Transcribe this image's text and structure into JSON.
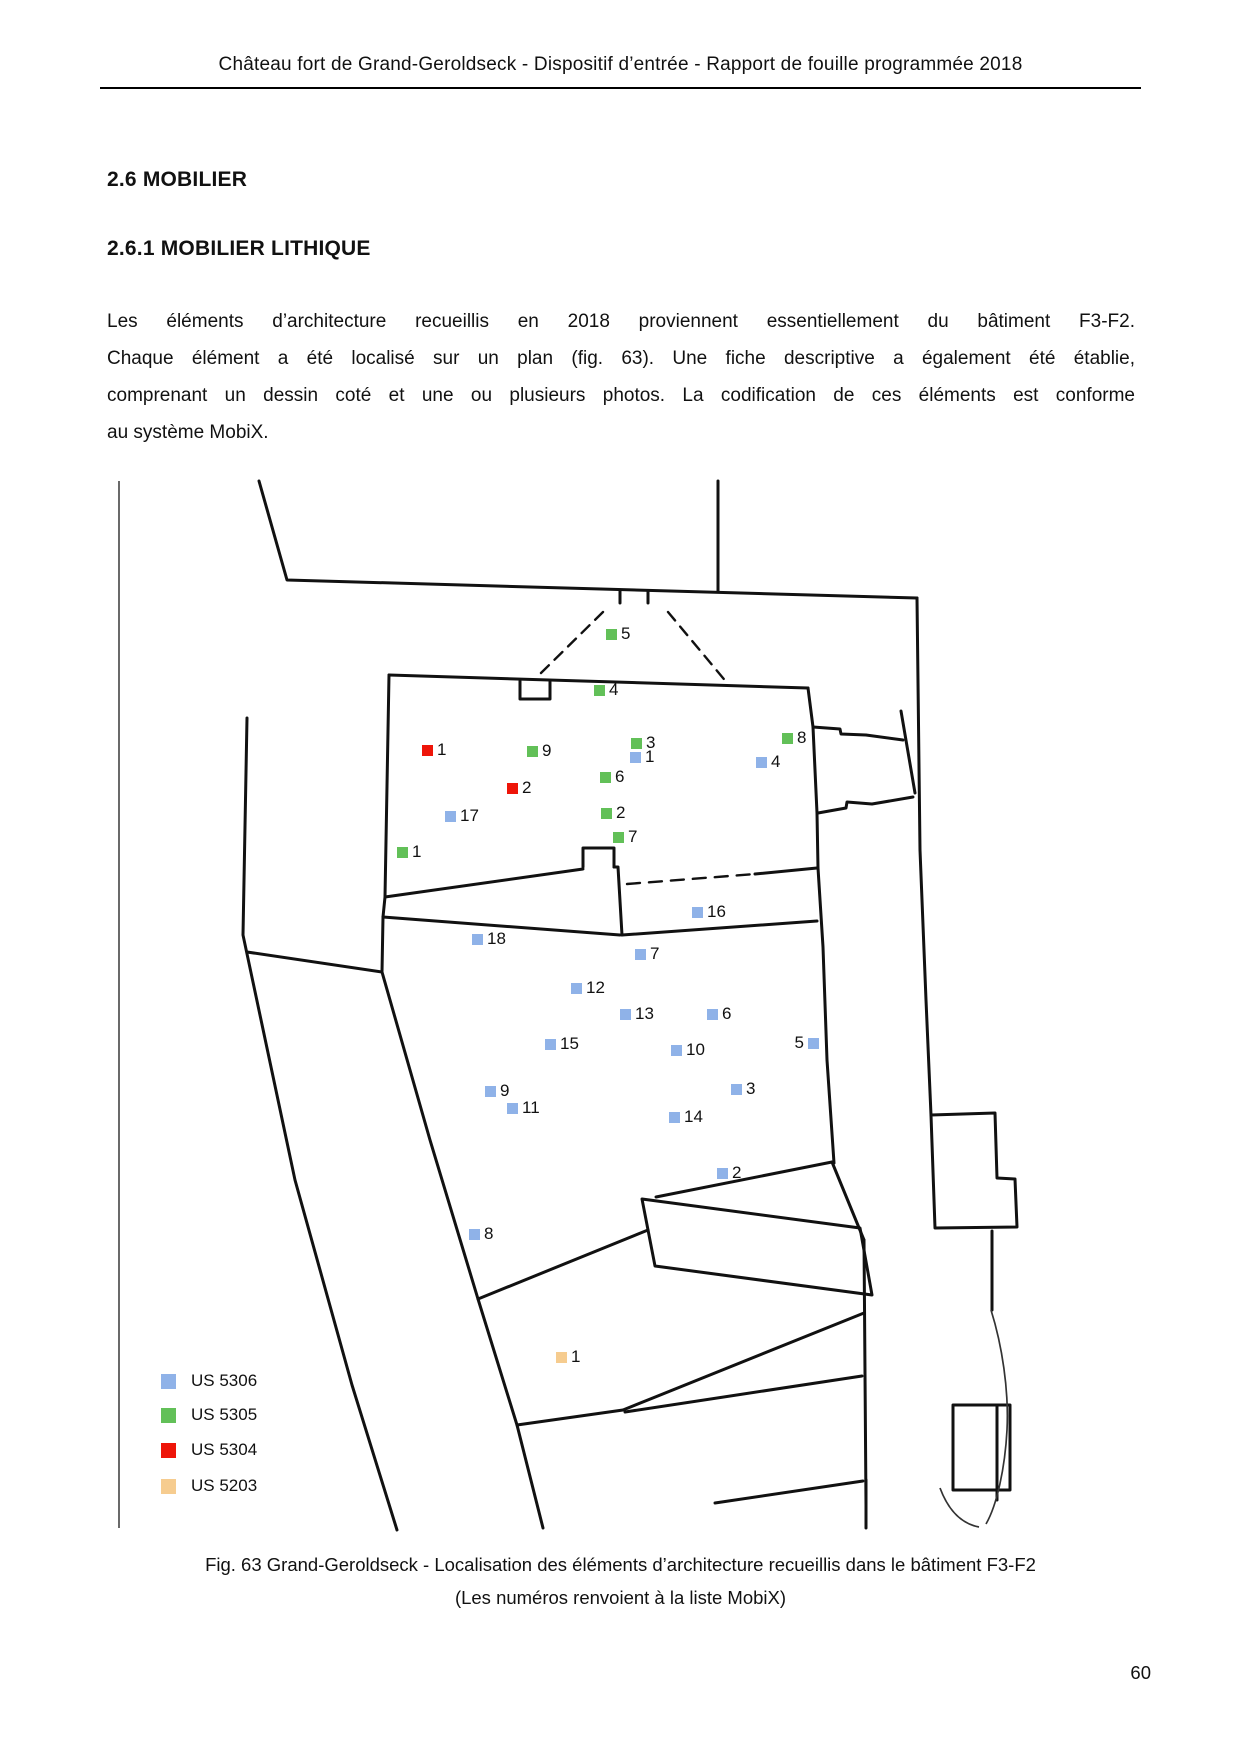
{
  "page": {
    "header": "Château fort de Grand-Geroldseck - Dispositif d’entrée - Rapport de fouille programmée 2018",
    "page_number": "60"
  },
  "sections": {
    "heading1": "2.6 MOBILIER",
    "heading2": "2.6.1 MOBILIER LITHIQUE",
    "paragraph_lines": [
      "Les éléments d’architecture recueillis en 2018 proviennent essentiellement du bâtiment F3-F2.",
      "Chaque élément a été localisé sur un plan (fig. 63). Une fiche descriptive a également été établie,",
      "comprenant un dessin coté et une ou plusieurs photos. La codification de ces éléments est conforme",
      "au système MobiX."
    ]
  },
  "figure": {
    "caption_line1": "Fig. 63 Grand-Geroldseck - Localisation des éléments d’architecture recueillis dans le bâtiment F3-F2",
    "caption_line2": "(Les numéros renvoient à la liste MobiX)",
    "colors": {
      "US5306": "#8fb2e8",
      "US5305": "#62c058",
      "US5304": "#ee1509",
      "US5203": "#f6cc8f"
    },
    "legend": [
      {
        "label": "US 5306",
        "color_key": "US5306",
        "x": 161,
        "y": 1380
      },
      {
        "label": "US 5305",
        "color_key": "US5305",
        "x": 161,
        "y": 1414
      },
      {
        "label": "US 5304",
        "color_key": "US5304",
        "x": 161,
        "y": 1449
      },
      {
        "label": "US 5203",
        "color_key": "US5203",
        "x": 161,
        "y": 1485
      }
    ],
    "markers": [
      {
        "us": "US5305",
        "label": "5",
        "x": 612,
        "y": 634,
        "side": "right"
      },
      {
        "us": "US5305",
        "label": "4",
        "x": 600,
        "y": 690,
        "side": "right"
      },
      {
        "us": "US5305",
        "label": "3",
        "x": 637,
        "y": 743,
        "side": "right"
      },
      {
        "us": "US5305",
        "label": "9",
        "x": 533,
        "y": 751,
        "side": "right"
      },
      {
        "us": "US5305",
        "label": "8",
        "x": 788,
        "y": 738,
        "side": "right"
      },
      {
        "us": "US5305",
        "label": "6",
        "x": 606,
        "y": 777,
        "side": "right"
      },
      {
        "us": "US5305",
        "label": "2",
        "x": 607,
        "y": 813,
        "side": "right"
      },
      {
        "us": "US5305",
        "label": "7",
        "x": 619,
        "y": 837,
        "side": "right"
      },
      {
        "us": "US5305",
        "label": "1",
        "x": 403,
        "y": 852,
        "side": "right"
      },
      {
        "us": "US5304",
        "label": "1",
        "x": 428,
        "y": 750,
        "side": "right"
      },
      {
        "us": "US5304",
        "label": "2",
        "x": 513,
        "y": 788,
        "side": "right"
      },
      {
        "us": "US5306",
        "label": "1",
        "x": 636,
        "y": 757,
        "side": "right"
      },
      {
        "us": "US5306",
        "label": "4",
        "x": 762,
        "y": 762,
        "side": "right"
      },
      {
        "us": "US5306",
        "label": "17",
        "x": 451,
        "y": 816,
        "side": "right"
      },
      {
        "us": "US5306",
        "label": "16",
        "x": 698,
        "y": 912,
        "side": "right"
      },
      {
        "us": "US5306",
        "label": "18",
        "x": 478,
        "y": 939,
        "side": "right"
      },
      {
        "us": "US5306",
        "label": "7",
        "x": 641,
        "y": 954,
        "side": "right"
      },
      {
        "us": "US5306",
        "label": "12",
        "x": 577,
        "y": 988,
        "side": "right"
      },
      {
        "us": "US5306",
        "label": "13",
        "x": 626,
        "y": 1014,
        "side": "right"
      },
      {
        "us": "US5306",
        "label": "6",
        "x": 713,
        "y": 1014,
        "side": "right"
      },
      {
        "us": "US5306",
        "label": "15",
        "x": 551,
        "y": 1044,
        "side": "right"
      },
      {
        "us": "US5306",
        "label": "10",
        "x": 677,
        "y": 1050,
        "side": "right"
      },
      {
        "us": "US5306",
        "label": "5",
        "x": 813,
        "y": 1043,
        "side": "left"
      },
      {
        "us": "US5306",
        "label": "9",
        "x": 491,
        "y": 1091,
        "side": "right"
      },
      {
        "us": "US5306",
        "label": "3",
        "x": 737,
        "y": 1089,
        "side": "right"
      },
      {
        "us": "US5306",
        "label": "11",
        "x": 513,
        "y": 1108,
        "side": "right"
      },
      {
        "us": "US5306",
        "label": "14",
        "x": 675,
        "y": 1117,
        "side": "right"
      },
      {
        "us": "US5306",
        "label": "2",
        "x": 723,
        "y": 1173,
        "side": "right"
      },
      {
        "us": "US5306",
        "label": "8",
        "x": 475,
        "y": 1234,
        "side": "right"
      },
      {
        "us": "US5203",
        "label": "1",
        "x": 562,
        "y": 1357,
        "side": "right"
      }
    ]
  }
}
